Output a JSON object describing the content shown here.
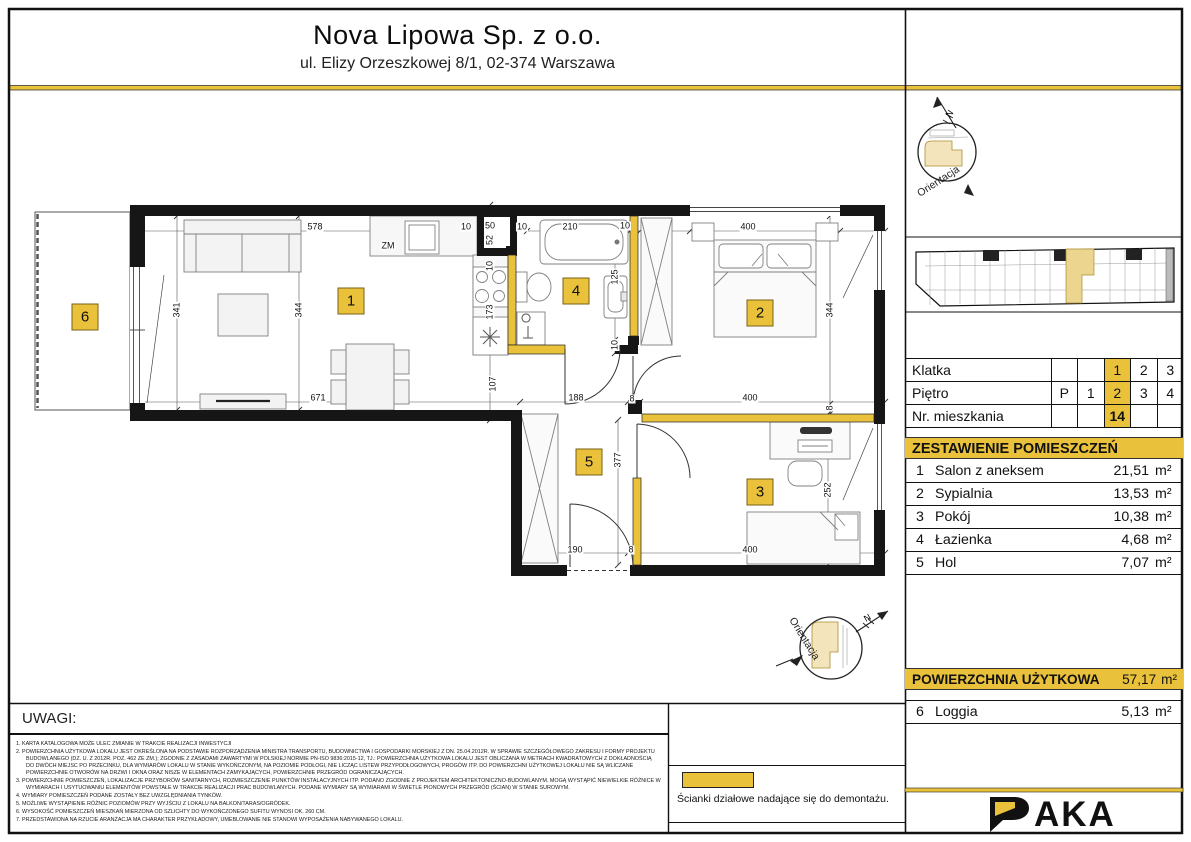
{
  "colors": {
    "accent": "#e9c13a",
    "accent_pale": "#f3e4bb",
    "unit_gold": "#ecd58f"
  },
  "header": {
    "company": "Nova Lipowa Sp. z o.o.",
    "address": "ul. Elizy Orzeszkowej 8/1, 02-374 Warszawa"
  },
  "compass": {
    "label": "Orientacja",
    "north": "N"
  },
  "location_table": {
    "rows": [
      {
        "label": "Klatka",
        "cells": [
          "",
          "",
          "1",
          "2",
          "3"
        ],
        "highlight": 2,
        "bold": false
      },
      {
        "label": "Piętro",
        "cells": [
          "P",
          "1",
          "2",
          "3",
          "4"
        ],
        "highlight": 2,
        "bold": false
      },
      {
        "label": "Nr. mieszkania",
        "cells": [
          "",
          "",
          "14",
          "",
          ""
        ],
        "highlight": 2,
        "bold": true
      }
    ]
  },
  "rooms": {
    "title": "ZESTAWIENIE POMIESZCZEŃ",
    "items": [
      {
        "no": "1",
        "name": "Salon z aneksem",
        "area": "21,51",
        "unit": "m²"
      },
      {
        "no": "2",
        "name": "Sypialnia",
        "area": "13,53",
        "unit": "m²"
      },
      {
        "no": "3",
        "name": "Pokój",
        "area": "10,38",
        "unit": "m²"
      },
      {
        "no": "4",
        "name": "Łazienka",
        "area": "4,68",
        "unit": "m²"
      },
      {
        "no": "5",
        "name": "Hol",
        "area": "7,07",
        "unit": "m²"
      }
    ],
    "total_label": "POWIERZCHNIA UŻYTKOWA",
    "total_area": "57,17",
    "total_unit": "m²",
    "extra": {
      "no": "6",
      "name": "Loggia",
      "area": "5,13",
      "unit": "m²"
    }
  },
  "notes": {
    "title": "UWAGI:",
    "items": [
      "1. KARTA KATALOGOWA MOŻE ULEC ZMIANIE W TRAKCIE REALIZACJI INWESTYCJI",
      "2. POWIERZCHNIA UŻYTKOWA LOKALU JEST OKREŚLONA NA PODSTAWIE ROZPORZĄDZENIA MINISTRA TRANSPORTU, BUDOWNICTWA I GOSPODARKI MORSKIEJ Z DN. 25.04.2012R. W SPRAWIE SZCZEGÓŁOWEGO ZAKRESU I FORMY PROJEKTU BUDOWLANEGO (DZ. U. Z 2012R. POZ. 462 ZE ZM.); ZGODNIE Z ZASADAMI ZAWARTYMI W POLSKIEJ NORMIE PN-ISO 9836:2015-12, TJ.: POWIERZCHNIA UŻYTKOWA LOKALU JEST OBLICZANA W METRACH KWADRATOWYCH Z DOKŁADNOŚCIĄ DO DWÓCH MIEJSC PO PRZECINKU, DLA WYMIARÓW LOKALU W STANIE WYKOŃCZONYM, NA POZIOMIE PODŁOGI, NIE LICZĄC LISTEW PRZYPODŁOGOWYCH, PROGÓW ITP. DO POWIERZCHNI UŻYTKOWEJ LOKALU NIE SĄ WLICZANE POWIERZCHNIE OTWORÓW NA DRZWI I OKNA ORAZ NISZE W ELEMENTACH ZAMYKAJĄCYCH, POWIERZCHNIE PRZEGRÓD OGRANICZAJĄCYCH.",
      "3. POWIERZCHNIE POMIESZCZEŃ, LOKALIZACJE PRZYBORÓW SANITARNYCH, ROZMIESZCZENIE PUNKTÓW INSTALACYJNYCH ITP. PODANO ZGODNIE Z PROJEKTEM ARCHITEKTONICZNO-BUDOWLANYM. MOGĄ WYSTĄPIĆ NIEWIELKIE RÓŻNICE W WYMIARACH I USYTUOWANIU ELEMENTÓW POWSTAŁE W TRAKCIE REALIZACJI PRAC BUDOWLANYCH. PODANE WYMIARY SĄ WYMIARAMI W ŚWIETLE PIONOWYCH PRZEGRÓD (ŚCIAN) W STANIE SUROWYM.",
      "4. WYMIARY POMIESZCZEŃ PODANE ZOSTAŁY BEZ UWZGLĘDNIANIA TYNKÓW.",
      "5. MOŻLIWE WYSTĄPIENIE RÓŻNIC POZIOMÓW PRZY WYJŚCIU Z LOKALU NA BALKON/TARAS/OGRÓDEK.",
      "6. WYSOKOŚĆ POMIESZCZEŃ MIESZKAŃ MIERZONA OD SZLICHTY DO WYKOŃCZONEGO SUFITU WYNOSI OK. 260 CM.",
      "7. PRZEDSTAWIONA NA RZUCIE ARANŻACJA MA CHARAKTER PRZYKŁADOWY, UMEBLOWANIE NIE STANOWI WYPOSAŻENIA NABYWANEGO LOKALU."
    ]
  },
  "legend": {
    "text": "Ścianki działowe nadające się do demontażu."
  },
  "logo": {
    "brand": "PAKA"
  },
  "plan": {
    "badges": [
      {
        "n": "1",
        "x": 351,
        "y": 301
      },
      {
        "n": "2",
        "x": 760,
        "y": 313
      },
      {
        "n": "3",
        "x": 760,
        "y": 492
      },
      {
        "n": "4",
        "x": 576,
        "y": 291
      },
      {
        "n": "5",
        "x": 589,
        "y": 462
      },
      {
        "n": "6",
        "x": 85,
        "y": 317
      }
    ],
    "dimensions": [
      {
        "t": "578",
        "x": 315,
        "y": 227,
        "r": 0
      },
      {
        "t": "10",
        "x": 466,
        "y": 227,
        "r": 0
      },
      {
        "t": "50",
        "x": 490,
        "y": 226,
        "r": 0
      },
      {
        "t": "10",
        "x": 522,
        "y": 227,
        "r": 0
      },
      {
        "t": "210",
        "x": 570,
        "y": 227,
        "r": 0
      },
      {
        "t": "10",
        "x": 625,
        "y": 226,
        "r": 0
      },
      {
        "t": "400",
        "x": 748,
        "y": 227,
        "r": 0
      },
      {
        "t": "341",
        "x": 177,
        "y": 310,
        "r": -90
      },
      {
        "t": "344",
        "x": 299,
        "y": 310,
        "r": -90
      },
      {
        "t": "52",
        "x": 490,
        "y": 240,
        "r": -90
      },
      {
        "t": "10",
        "x": 490,
        "y": 266,
        "r": -90
      },
      {
        "t": "173",
        "x": 490,
        "y": 312,
        "r": -90
      },
      {
        "t": "107",
        "x": 493,
        "y": 384,
        "r": -90
      },
      {
        "t": "125",
        "x": 615,
        "y": 277,
        "r": -90
      },
      {
        "t": "10",
        "x": 615,
        "y": 345,
        "r": -90
      },
      {
        "t": "344",
        "x": 830,
        "y": 310,
        "r": -90
      },
      {
        "t": "8",
        "x": 830,
        "y": 408,
        "r": -90
      },
      {
        "t": "671",
        "x": 318,
        "y": 398,
        "r": 0
      },
      {
        "t": "188",
        "x": 576,
        "y": 398,
        "r": 0
      },
      {
        "t": "8",
        "x": 632,
        "y": 399,
        "r": 0
      },
      {
        "t": "400",
        "x": 750,
        "y": 398,
        "r": 0
      },
      {
        "t": "377",
        "x": 618,
        "y": 460,
        "r": -90
      },
      {
        "t": "252",
        "x": 828,
        "y": 490,
        "r": -90
      },
      {
        "t": "190",
        "x": 575,
        "y": 550,
        "r": 0
      },
      {
        "t": "8",
        "x": 631,
        "y": 550,
        "r": 0
      },
      {
        "t": "400",
        "x": 750,
        "y": 550,
        "r": 0
      },
      {
        "t": "ZM",
        "x": 388,
        "y": 246,
        "r": 0
      }
    ]
  }
}
